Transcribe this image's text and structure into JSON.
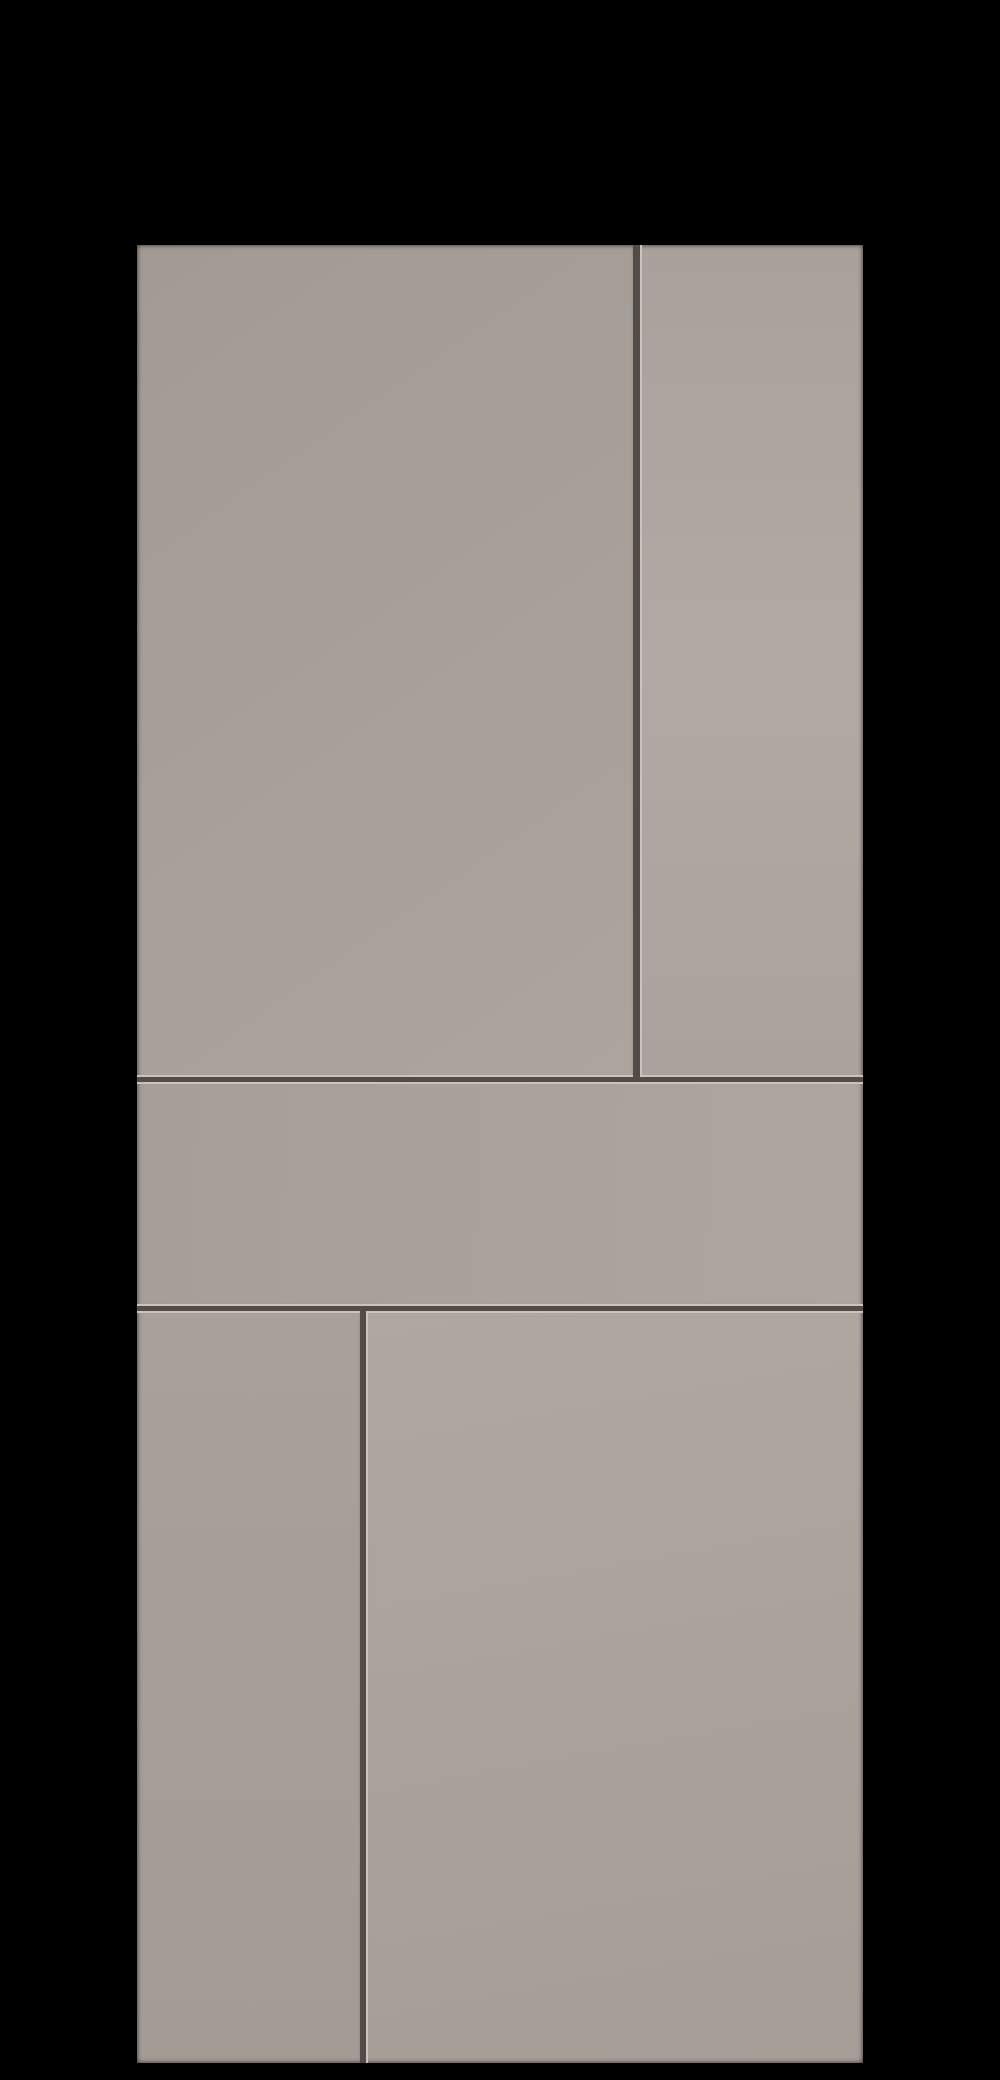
{
  "image": {
    "type": "3d-product-render",
    "description": "Matte greige wall/door paneling composition with thin recessed seams, centered on a black background",
    "background_color": "#000000"
  },
  "colors": {
    "base": "#a9a099",
    "seam": "#514c48",
    "seam_highlight": "#cbc3bc",
    "edge_shadow": "rgba(0,0,0,0.45)"
  },
  "assembly": {
    "x": 137,
    "y": 245,
    "width": 726,
    "height": 1818
  },
  "panels": [
    {
      "id": "top-left-panel",
      "x": 0,
      "y": 0,
      "w": 496,
      "h": 832,
      "gradient_angle": 145,
      "gradient_stops": [
        "#a39a94",
        "#a89f99",
        "#ada49d"
      ],
      "highlight_edges": [
        "bottom"
      ],
      "shadow_edges": [
        "top",
        "left"
      ]
    },
    {
      "id": "top-right-panel",
      "x": 503,
      "y": 0,
      "w": 223,
      "h": 832,
      "gradient_angle": 180,
      "gradient_stops": [
        "#aaa19a",
        "#b2a9a2",
        "#aba29b"
      ],
      "highlight_edges": [
        "left",
        "bottom"
      ],
      "shadow_edges": [
        "top",
        "right"
      ]
    },
    {
      "id": "middle-rail-panel",
      "x": 0,
      "y": 837,
      "w": 726,
      "h": 224,
      "gradient_angle": 92,
      "gradient_stops": [
        "#a79e98",
        "#aea59e"
      ],
      "highlight_edges": [
        "top",
        "bottom"
      ],
      "shadow_edges": [
        "left",
        "right"
      ]
    },
    {
      "id": "bottom-left-panel",
      "x": 0,
      "y": 1066,
      "w": 223,
      "h": 752,
      "gradient_angle": 180,
      "gradient_stops": [
        "#a9a09a",
        "#a49b95"
      ],
      "highlight_edges": [
        "top"
      ],
      "shadow_edges": [
        "left",
        "bottom"
      ]
    },
    {
      "id": "bottom-right-panel",
      "x": 229,
      "y": 1066,
      "w": 497,
      "h": 752,
      "gradient_angle": 170,
      "gradient_stops": [
        "#b0a7a0",
        "#a69d97"
      ],
      "highlight_edges": [
        "left",
        "top"
      ],
      "shadow_edges": [
        "right",
        "bottom"
      ]
    }
  ]
}
